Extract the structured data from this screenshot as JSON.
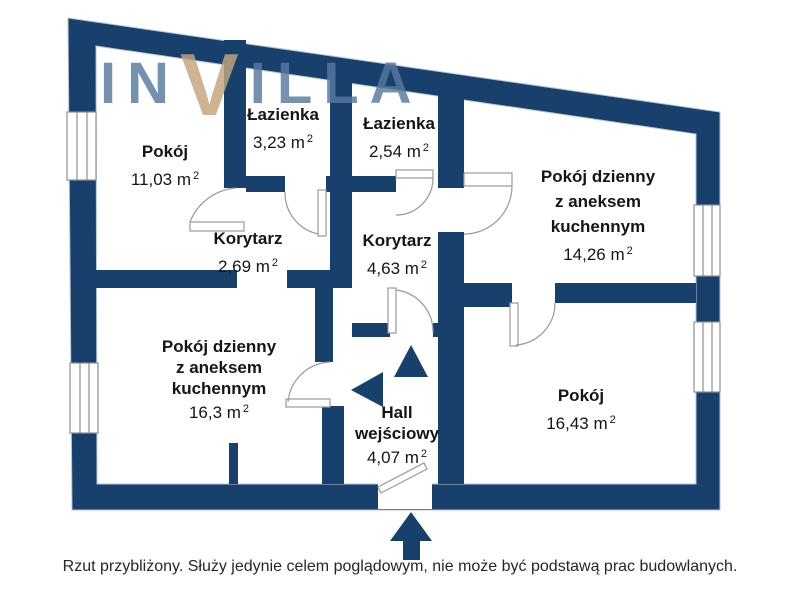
{
  "watermark": {
    "prefix": "IN",
    "accent": "V",
    "suffix": "ILLA"
  },
  "rooms": [
    {
      "id": "pokoj-top-left",
      "name_lines": [
        "Pokój"
      ],
      "area": "11,03 m",
      "area_sup": "2"
    },
    {
      "id": "lazienka-left",
      "name_lines": [
        "Łazienka"
      ],
      "area": "3,23 m",
      "area_sup": "2"
    },
    {
      "id": "lazienka-center",
      "name_lines": [
        "Łazienka"
      ],
      "area": "2,54 m",
      "area_sup": "2"
    },
    {
      "id": "living-right",
      "name_lines": [
        "Pokój dzienny",
        "z aneksem",
        "kuchennym"
      ],
      "area": "14,26 m",
      "area_sup": "2"
    },
    {
      "id": "korytarz-left",
      "name_lines": [
        "Korytarz"
      ],
      "area": "2,69 m",
      "area_sup": "2"
    },
    {
      "id": "korytarz-center",
      "name_lines": [
        "Korytarz"
      ],
      "area": "4,63 m",
      "area_sup": "2"
    },
    {
      "id": "living-left",
      "name_lines": [
        "Pokój dzienny",
        "z aneksem",
        "kuchennym"
      ],
      "area": "16,3 m",
      "area_sup": "2"
    },
    {
      "id": "pokoj-bottom-right",
      "name_lines": [
        "Pokój"
      ],
      "area": "16,43 m",
      "area_sup": "2"
    },
    {
      "id": "hall",
      "name_lines": [
        "Hall",
        "wejściowy"
      ],
      "area": "4,07 m",
      "area_sup": "2"
    }
  ],
  "footer": {
    "disclaimer": "Rzut przybliżony. Służy jedynie celem poglądowym, nie może być podstawą prac budowlanych."
  },
  "icons": {
    "hall_up_arrow": "triangle-up",
    "hall_left_arrow": "triangle-left",
    "entry_arrow": "block-arrow-up"
  },
  "colors": {
    "wall": "#17406d",
    "watermark_blue": "#56799e",
    "watermark_gold": "#c5a47d",
    "door_line": "#999999",
    "text": "#151515"
  }
}
